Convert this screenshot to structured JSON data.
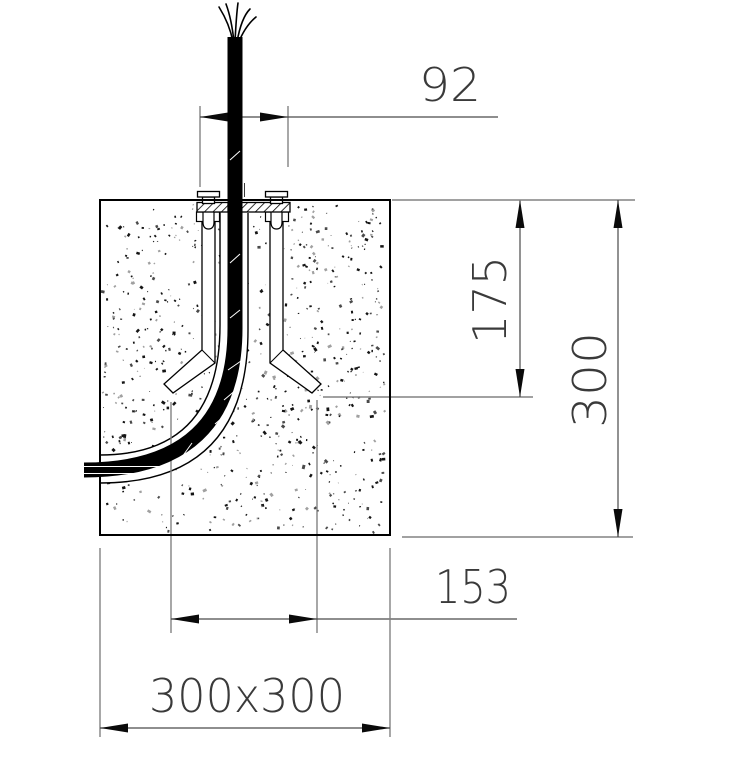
{
  "drawing": {
    "type": "foundation-anchor-cross-section",
    "dimension_labels": {
      "plate_width": "92",
      "anchor_depth": "175",
      "block_height": "300",
      "foot_span": "153",
      "block_size": "300x300"
    },
    "colors": {
      "outline": "#000000",
      "dimension_line": "#4a4a4a",
      "extension_line": "#828282",
      "text": "#3a3a3a",
      "background": "#ffffff"
    }
  }
}
